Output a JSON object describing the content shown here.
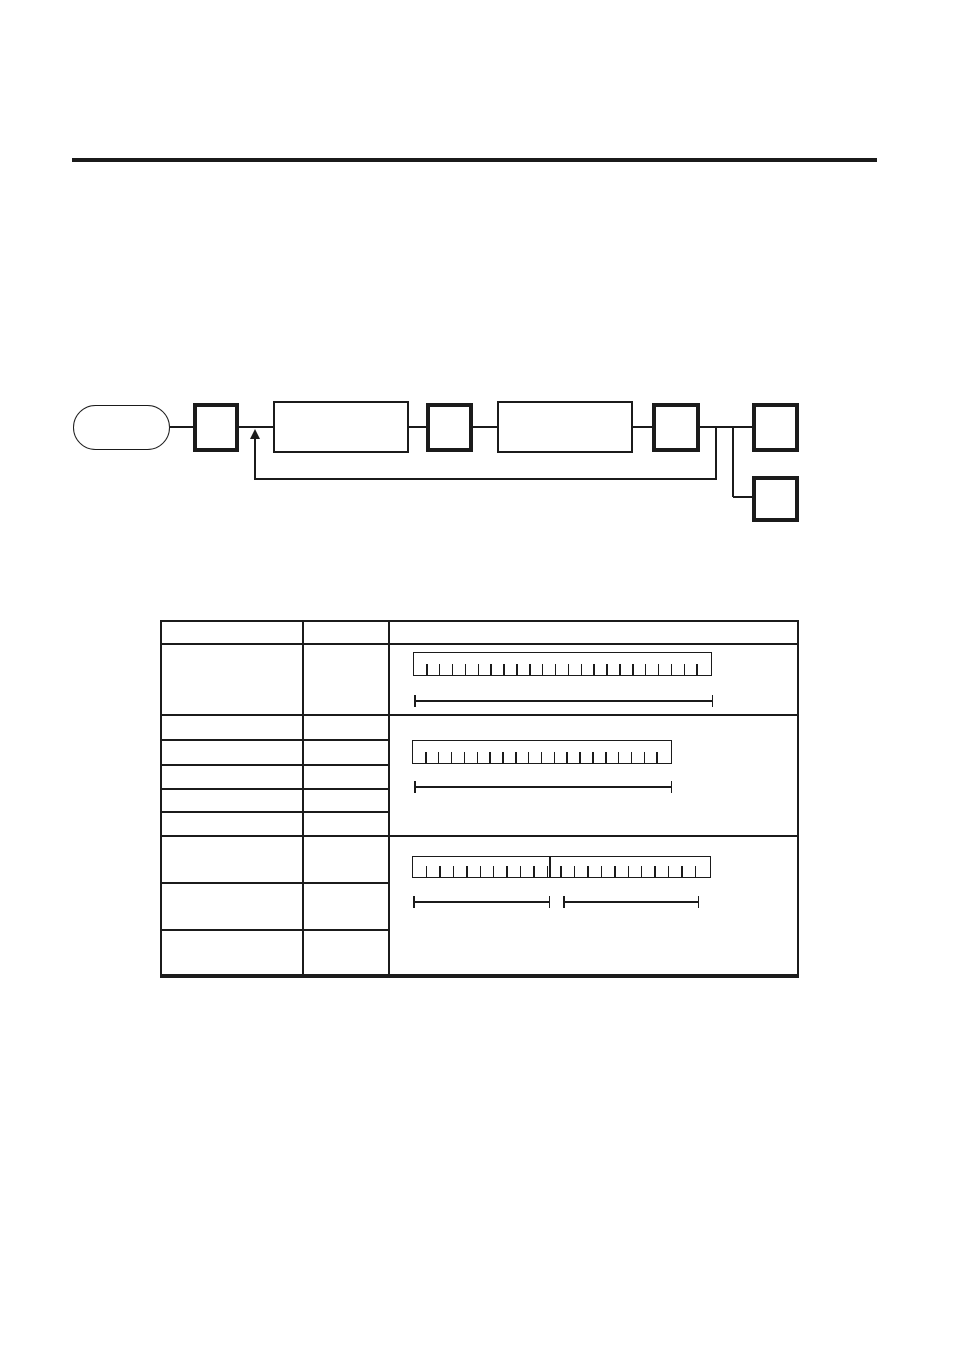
{
  "page": {
    "width": 954,
    "height": 1348,
    "background": "#ffffff",
    "ink": "#1b1b1b",
    "header_rule": {
      "x": 72,
      "y": 158,
      "width": 805,
      "height": 4
    }
  },
  "flowchart": {
    "nodes": [
      {
        "id": "start-terminator",
        "shape": "stadium",
        "x": 73,
        "y": 405,
        "w": 97,
        "h": 45,
        "stroke": 1.5
      },
      {
        "id": "key-box-1",
        "shape": "square",
        "x": 193,
        "y": 403,
        "w": 46,
        "h": 49,
        "stroke": 4.5
      },
      {
        "id": "process-box-1",
        "shape": "rect",
        "x": 273,
        "y": 401,
        "w": 136,
        "h": 52,
        "stroke": 2
      },
      {
        "id": "key-box-2",
        "shape": "square",
        "x": 426,
        "y": 403,
        "w": 47,
        "h": 49,
        "stroke": 4.5
      },
      {
        "id": "process-box-2",
        "shape": "rect",
        "x": 497,
        "y": 401,
        "w": 136,
        "h": 52,
        "stroke": 2
      },
      {
        "id": "key-box-3",
        "shape": "square",
        "x": 652,
        "y": 403,
        "w": 48,
        "h": 49,
        "stroke": 4.5
      },
      {
        "id": "key-box-4",
        "shape": "square",
        "x": 752,
        "y": 403,
        "w": 47,
        "h": 49,
        "stroke": 4.5
      },
      {
        "id": "key-box-5",
        "shape": "square",
        "x": 752,
        "y": 476,
        "w": 47,
        "h": 46,
        "stroke": 4.5
      }
    ],
    "connectors": [
      {
        "type": "h",
        "x1": 170,
        "x2": 193,
        "y": 427
      },
      {
        "type": "h",
        "x1": 239,
        "x2": 273,
        "y": 427
      },
      {
        "type": "h",
        "x1": 409,
        "x2": 426,
        "y": 427
      },
      {
        "type": "h",
        "x1": 473,
        "x2": 497,
        "y": 427
      },
      {
        "type": "h",
        "x1": 633,
        "x2": 652,
        "y": 427
      },
      {
        "type": "h",
        "x1": 700,
        "x2": 752,
        "y": 427
      },
      {
        "type": "v",
        "x": 733,
        "y1": 427,
        "y2": 497,
        "thin": false
      },
      {
        "type": "h",
        "x1": 733,
        "x2": 752,
        "y": 497
      },
      {
        "type": "v",
        "x": 716,
        "y1": 427,
        "y2": 480,
        "thin": true
      },
      {
        "type": "h",
        "x1": 255,
        "x2": 717,
        "y": 479,
        "thin": true
      },
      {
        "type": "v",
        "x": 255,
        "y1": 438,
        "y2": 480,
        "thin": true
      }
    ],
    "feedback_arrow": {
      "x": 255,
      "tip_y": 429,
      "head_w": 10,
      "head_h": 10
    }
  },
  "table": {
    "x": 160,
    "y": 620,
    "w": 639,
    "h": 358,
    "border": 2,
    "border_bottom": 4,
    "column_separators": [
      140,
      226
    ],
    "full_row_separators": [
      21,
      92,
      213
    ],
    "partial_row_separators": [
      117,
      142,
      166,
      189,
      260,
      307
    ],
    "partial_row_span": 228,
    "rulers": [
      {
        "id": "scale-ruler-1",
        "x": 251,
        "y": 30,
        "w": 299,
        "h": 24,
        "ticks": 22,
        "divider_at": null
      },
      {
        "id": "scale-ruler-2",
        "x": 250,
        "y": 118,
        "w": 260,
        "h": 24,
        "ticks": 19,
        "divider_at": null
      },
      {
        "id": "scale-ruler-3",
        "x": 250,
        "y": 234,
        "w": 299,
        "h": 22,
        "ticks": 21,
        "divider_at": 136
      }
    ],
    "tick_height": 11,
    "dimension_lines": [
      {
        "id": "dimension-line-1",
        "x": 252,
        "y": 79,
        "w": 299
      },
      {
        "id": "dimension-line-2",
        "x": 252,
        "y": 165,
        "w": 258
      },
      {
        "id": "dimension-line-3-left",
        "x": 251,
        "y": 280,
        "w": 137
      },
      {
        "id": "dimension-line-3-right",
        "x": 401,
        "y": 280,
        "w": 136
      }
    ],
    "dim_cap_height": 12
  }
}
